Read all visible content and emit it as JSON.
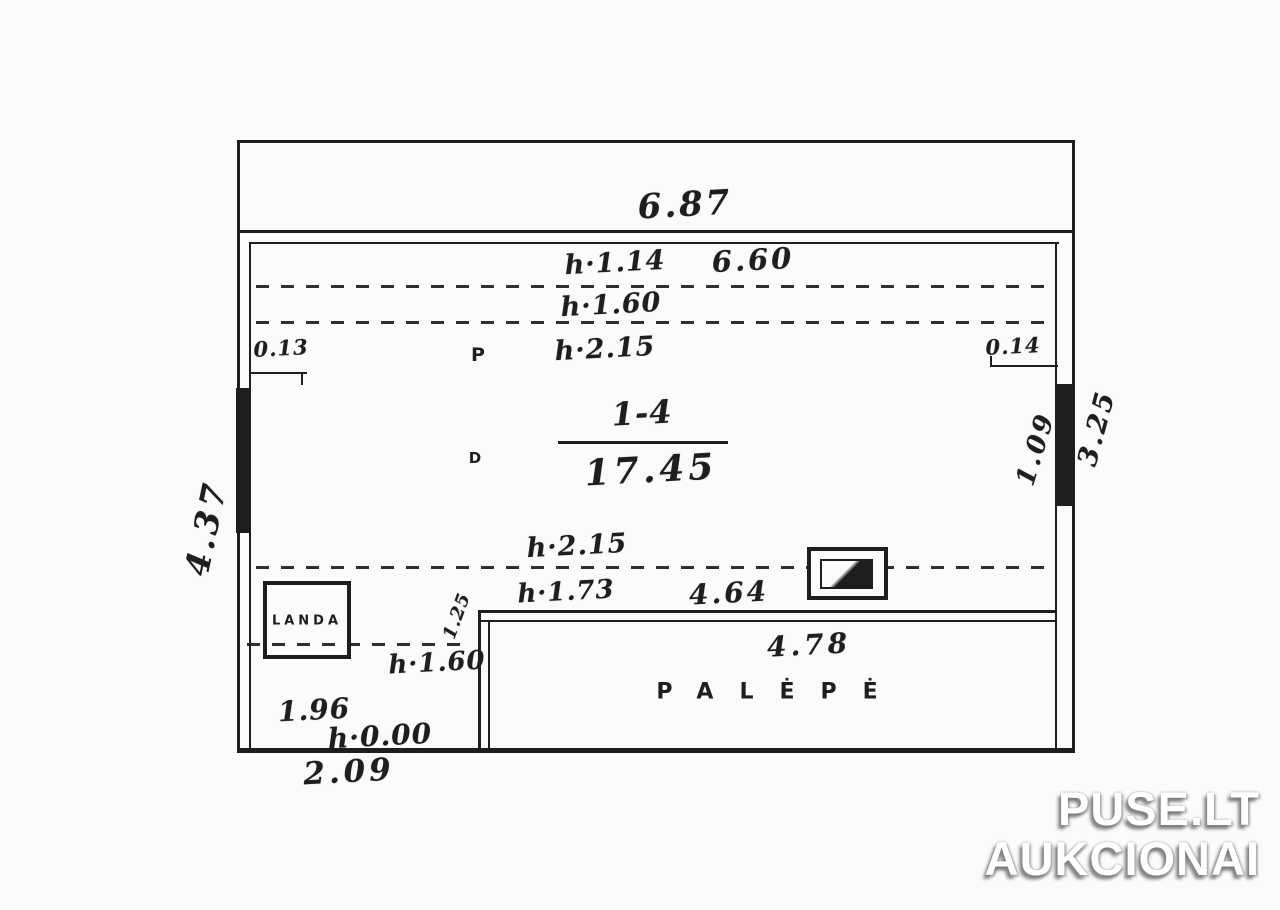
{
  "colors": {
    "ink": "#1e1e1e",
    "paper": "#fbfbfb",
    "watermark_text": "#ffffff",
    "watermark_shadow": "#8f8f8f"
  },
  "plan": {
    "room_label": {
      "number": "1-4",
      "area": "17.45"
    },
    "dims": {
      "top_width": "6.87",
      "inner_width": "6.60",
      "left_height": "4.37",
      "right_inner_height": "1.09",
      "right_outer_height": "3.25",
      "offset_left": "0.13",
      "offset_right": "0.14",
      "mid_width": "4.64",
      "palepe_width": "4.78",
      "corner_diag": "1.25",
      "bottom_left_width": "1.96",
      "bottom_width": "2.09"
    },
    "heights": {
      "h_114": "h·1.14",
      "h_160a": "h·1.60",
      "h_215a": "h·2.15",
      "h_215b": "h·2.15",
      "h_173": "h·1.73",
      "h_160b": "h·1.60",
      "h_000": "h·0.00"
    },
    "marks": {
      "p": "P",
      "d": "D"
    },
    "rooms": {
      "palepe": "PALĖPĖ",
      "landa": "LANDA"
    }
  },
  "watermark": {
    "line1": "PUSE.LT",
    "line2": "AUKCIONAI"
  }
}
